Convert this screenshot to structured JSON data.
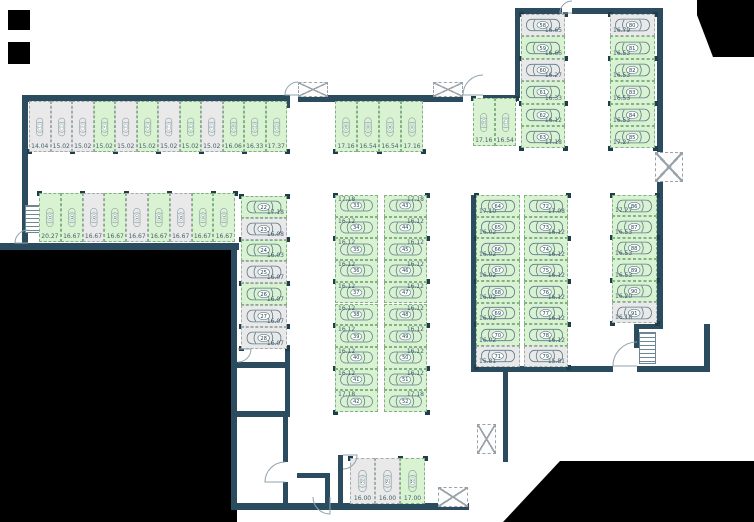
{
  "canvas": {
    "w": 754,
    "h": 522
  },
  "colors": {
    "available_fill": "#d9f2d2",
    "available_border": "#82b184",
    "occupied_fill": "#e9e9e9",
    "occupied_border": "#a6abad",
    "wall": "#2b4c5e",
    "outside": "#000000",
    "label_text": "#45606d",
    "car_outline": "#5d7a87",
    "badge_fill": "#ffffff",
    "badge_text": "#24454f",
    "column_dot": "#1f3e4b",
    "door_arc": "#8fa3ad"
  },
  "icons": {
    "car": "car-top-view-icon",
    "shaft": "crossed-shaft-icon",
    "stairs": "staircase-icon",
    "door": "door-swing-arc-icon"
  },
  "groups": [
    {
      "name": "top-row",
      "orient": "v",
      "x": 29,
      "y": 101,
      "sw": 21.5,
      "sh": 51,
      "dots": [
        "bottom"
      ],
      "label": "b",
      "spots": [
        {
          "n": "1",
          "a": "14.04",
          "s": "grey"
        },
        {
          "n": "2",
          "a": "15.02",
          "s": "grey"
        },
        {
          "n": "3",
          "a": "15.02",
          "s": "grey"
        },
        {
          "n": "4",
          "a": "15.02",
          "s": "green"
        },
        {
          "n": "5",
          "a": "15.02",
          "s": "grey"
        },
        {
          "n": "6",
          "a": "15.02",
          "s": "green"
        },
        {
          "n": "7",
          "a": "15.02",
          "s": "grey"
        },
        {
          "n": "8",
          "a": "15.02",
          "s": "green"
        },
        {
          "n": "9",
          "a": "15.02",
          "s": "grey"
        },
        {
          "n": "10",
          "a": "16.06",
          "s": "green"
        },
        {
          "n": "11",
          "a": "16.33",
          "s": "green"
        },
        {
          "n": "12",
          "a": "17.37",
          "s": "green"
        }
      ]
    },
    {
      "name": "second-row",
      "orient": "v",
      "x": 39,
      "y": 193,
      "sw": 21.8,
      "sh": 49,
      "dots": [
        "top"
      ],
      "label": "b",
      "spots": [
        {
          "n": "13",
          "a": "20.27",
          "s": "green"
        },
        {
          "n": "14",
          "a": "16.67",
          "s": "green"
        },
        {
          "n": "15",
          "a": "16.67",
          "s": "grey"
        },
        {
          "n": "16",
          "a": "16.67",
          "s": "green"
        },
        {
          "n": "17",
          "a": "16.67",
          "s": "grey"
        },
        {
          "n": "18",
          "a": "16.67",
          "s": "green"
        },
        {
          "n": "19",
          "a": "16.67",
          "s": "grey"
        },
        {
          "n": "20",
          "a": "16.67",
          "s": "green"
        },
        {
          "n": "21",
          "a": "16.67",
          "s": "green"
        }
      ]
    },
    {
      "name": "left-column",
      "orient": "h",
      "x": 241,
      "y": 196,
      "sw": 46,
      "sh": 21.8,
      "dots": [
        "left",
        "right"
      ],
      "label": "br",
      "spots": [
        {
          "n": "22",
          "a": "17.18",
          "s": "green"
        },
        {
          "n": "23",
          "a": "16.08",
          "s": "grey"
        },
        {
          "n": "24",
          "a": "16.03",
          "s": "green"
        },
        {
          "n": "25",
          "a": "16.07",
          "s": "grey"
        },
        {
          "n": "26",
          "a": "16.07",
          "s": "green"
        },
        {
          "n": "27",
          "a": "16.07",
          "s": "grey"
        },
        {
          "n": "28",
          "a": "16.07",
          "s": "grey"
        }
      ]
    },
    {
      "name": "top-middle-row",
      "orient": "v",
      "x": 335,
      "y": 101,
      "sw": 22,
      "sh": 51,
      "dots": [
        "bottom"
      ],
      "label": "b",
      "spots": [
        {
          "n": "29",
          "a": "17.16",
          "s": "green"
        },
        {
          "n": "30",
          "a": "16.54",
          "s": "green"
        },
        {
          "n": "31",
          "a": "16.54",
          "s": "green"
        },
        {
          "n": "32",
          "a": "17.16",
          "s": "green"
        }
      ]
    },
    {
      "name": "mid-column-left",
      "orient": "h",
      "x": 335,
      "y": 195,
      "sw": 43,
      "sh": 21.7,
      "dots": [
        "left"
      ],
      "label": "tl",
      "spots": [
        {
          "n": "33",
          "a": "17.18",
          "s": "green"
        },
        {
          "n": "34",
          "a": "16.12",
          "s": "green"
        },
        {
          "n": "35",
          "a": "16.12",
          "s": "green"
        },
        {
          "n": "36",
          "a": "16.12",
          "s": "green"
        },
        {
          "n": "37",
          "a": "16.12",
          "s": "green"
        },
        {
          "n": "38",
          "a": "16.12",
          "s": "green"
        },
        {
          "n": "39",
          "a": "16.12",
          "s": "green"
        },
        {
          "n": "40",
          "a": "16.12",
          "s": "green"
        },
        {
          "n": "41",
          "a": "16.12",
          "s": "green"
        },
        {
          "n": "42",
          "a": "17.18",
          "s": "green"
        }
      ]
    },
    {
      "name": "mid-column-right",
      "orient": "h",
      "x": 384,
      "y": 195,
      "sw": 43,
      "sh": 21.7,
      "dots": [
        "right"
      ],
      "label": "tr",
      "spots": [
        {
          "n": "43",
          "a": "17.18",
          "s": "green"
        },
        {
          "n": "44",
          "a": "16.12",
          "s": "green"
        },
        {
          "n": "45",
          "a": "16.12",
          "s": "green"
        },
        {
          "n": "46",
          "a": "16.12",
          "s": "green"
        },
        {
          "n": "47",
          "a": "16.12",
          "s": "green"
        },
        {
          "n": "48",
          "a": "16.12",
          "s": "green"
        },
        {
          "n": "49",
          "a": "16.12",
          "s": "green"
        },
        {
          "n": "50",
          "a": "16.12",
          "s": "green"
        },
        {
          "n": "51",
          "a": "16.12",
          "s": "green"
        },
        {
          "n": "52",
          "a": "17.18",
          "s": "green"
        }
      ]
    },
    {
      "name": "bottom-middle-row",
      "orient": "v",
      "x": 350,
      "y": 458,
      "sw": 25,
      "sh": 46,
      "dots": [
        "top"
      ],
      "label": "b",
      "spots": [
        {
          "n": "53",
          "a": "16.00",
          "s": "grey"
        },
        {
          "n": "54",
          "a": "16.00",
          "s": "grey"
        },
        {
          "n": "55",
          "a": "17.00",
          "s": "green"
        }
      ]
    },
    {
      "name": "upper-right-pair",
      "orient": "v",
      "x": 473,
      "y": 98,
      "sw": 21.5,
      "sh": 48,
      "dots": [
        "top"
      ],
      "label": "b",
      "spots": [
        {
          "n": "56",
          "a": "17.16",
          "s": "green"
        },
        {
          "n": "57",
          "a": "16.54",
          "s": "green"
        }
      ]
    },
    {
      "name": "upper-right-column-left",
      "orient": "h",
      "x": 521,
      "y": 14,
      "sw": 44,
      "sh": 22.4,
      "dots": [
        "left",
        "right"
      ],
      "label": "br",
      "spots": [
        {
          "n": "58",
          "a": "16.65",
          "s": "grey"
        },
        {
          "n": "59",
          "a": "16.66",
          "s": "green"
        },
        {
          "n": "60",
          "a": "16.27",
          "s": "grey"
        },
        {
          "n": "61",
          "a": "16.33",
          "s": "green"
        },
        {
          "n": "62",
          "a": "16.12",
          "s": "green"
        },
        {
          "n": "63",
          "a": "17.18",
          "s": "green"
        }
      ]
    },
    {
      "name": "upper-right-column-right",
      "orient": "h",
      "x": 610,
      "y": 14,
      "sw": 45,
      "sh": 22.4,
      "dots": [
        "left",
        "right"
      ],
      "label": "bl",
      "spots": [
        {
          "n": "80",
          "a": "16.79",
          "s": "grey"
        },
        {
          "n": "81",
          "a": "16.53",
          "s": "green"
        },
        {
          "n": "82",
          "a": "16.53",
          "s": "green"
        },
        {
          "n": "83",
          "a": "16.53",
          "s": "green"
        },
        {
          "n": "84",
          "a": "16.53",
          "s": "green"
        },
        {
          "n": "85",
          "a": "17.27",
          "s": "green"
        }
      ]
    },
    {
      "name": "right-column-inner",
      "orient": "h",
      "x": 476,
      "y": 195,
      "sw": 44,
      "sh": 21.5,
      "dots": [
        "left"
      ],
      "label": "bl",
      "spots": [
        {
          "n": "64",
          "a": "17.10",
          "s": "green"
        },
        {
          "n": "65",
          "a": "16.02",
          "s": "green"
        },
        {
          "n": "66",
          "a": "16.02",
          "s": "green"
        },
        {
          "n": "67",
          "a": "16.02",
          "s": "green"
        },
        {
          "n": "68",
          "a": "16.02",
          "s": "green"
        },
        {
          "n": "69",
          "a": "16.02",
          "s": "green"
        },
        {
          "n": "70",
          "a": "16.02",
          "s": "green"
        },
        {
          "n": "71",
          "a": "15.81",
          "s": "grey"
        }
      ]
    },
    {
      "name": "right-column-outer",
      "orient": "h",
      "x": 524,
      "y": 195,
      "sw": 44,
      "sh": 21.5,
      "dots": [
        "right"
      ],
      "label": "br",
      "spots": [
        {
          "n": "72",
          "a": "17.08",
          "s": "green"
        },
        {
          "n": "73",
          "a": "16.12",
          "s": "green"
        },
        {
          "n": "74",
          "a": "16.12",
          "s": "green"
        },
        {
          "n": "75",
          "a": "16.12",
          "s": "green"
        },
        {
          "n": "76",
          "a": "16.12",
          "s": "green"
        },
        {
          "n": "77",
          "a": "16.12",
          "s": "green"
        },
        {
          "n": "78",
          "a": "16.12",
          "s": "green"
        },
        {
          "n": "79",
          "a": "15.81",
          "s": "grey"
        }
      ]
    },
    {
      "name": "far-right-column",
      "orient": "h",
      "x": 612,
      "y": 195,
      "sw": 45,
      "sh": 21.4,
      "dots": [
        "left",
        "right"
      ],
      "label": "bl",
      "spots": [
        {
          "n": "86",
          "a": "17.27",
          "s": "green"
        },
        {
          "n": "87",
          "a": "16.53",
          "s": "green"
        },
        {
          "n": "88",
          "a": "16.53",
          "s": "green"
        },
        {
          "n": "89",
          "a": "16.53",
          "s": "green"
        },
        {
          "n": "90",
          "a": "16.20",
          "s": "green"
        },
        {
          "n": "91",
          "a": "16.18",
          "s": "grey"
        }
      ]
    }
  ],
  "structure": {
    "walls": [
      [
        22,
        95,
        268,
        7
      ],
      [
        22,
        95,
        6,
        150
      ],
      [
        0,
        243,
        239,
        7
      ],
      [
        284,
        95,
        6,
        13
      ],
      [
        298,
        95,
        165,
        7
      ],
      [
        483,
        95,
        34,
        7
      ],
      [
        515,
        12,
        5,
        86
      ],
      [
        515,
        8,
        47,
        6
      ],
      [
        572,
        8,
        91,
        6
      ],
      [
        657,
        8,
        6,
        146
      ],
      [
        657,
        182,
        6,
        146
      ],
      [
        634,
        324,
        29,
        5
      ],
      [
        704,
        324,
        6,
        48
      ],
      [
        634,
        324,
        5,
        24
      ],
      [
        471,
        195,
        5,
        177
      ],
      [
        471,
        366,
        142,
        6
      ],
      [
        637,
        366,
        73,
        6
      ],
      [
        503,
        372,
        5,
        90
      ],
      [
        231,
        248,
        6,
        262
      ],
      [
        237,
        362,
        53,
        6
      ],
      [
        285,
        345,
        5,
        72
      ],
      [
        237,
        411,
        52,
        6
      ],
      [
        283,
        417,
        5,
        45
      ],
      [
        283,
        482,
        5,
        26
      ],
      [
        231,
        503,
        238,
        7
      ],
      [
        297,
        473,
        33,
        5
      ],
      [
        325,
        478,
        5,
        27
      ],
      [
        338,
        455,
        5,
        50
      ]
    ],
    "outside_rects": [
      [
        0,
        250,
        237,
        272
      ],
      [
        8,
        10,
        22,
        20
      ],
      [
        8,
        42,
        22,
        22
      ]
    ],
    "outside_polys": [
      [
        [
          697,
          0
        ],
        [
          754,
          0
        ],
        [
          754,
          57
        ],
        [
          713,
          57
        ],
        [
          697,
          15
        ]
      ],
      [
        [
          560,
          461
        ],
        [
          754,
          461
        ],
        [
          754,
          522
        ],
        [
          503,
          522
        ]
      ]
    ],
    "shafts": [
      [
        298,
        82,
        30,
        15
      ],
      [
        433,
        82,
        30,
        15
      ],
      [
        655,
        152,
        28,
        30
      ],
      [
        477,
        424,
        19,
        30
      ],
      [
        438,
        487,
        30,
        20
      ]
    ],
    "stairs": [
      [
        25,
        205,
        15,
        28
      ],
      [
        639,
        332,
        17,
        32
      ]
    ],
    "doors": [
      {
        "h": [
          298,
          95
        ],
        "r": 13,
        "a0": 180,
        "a1": 270
      },
      {
        "h": [
          483,
          95
        ],
        "r": 20,
        "a0": 180,
        "a1": 270
      },
      {
        "h": [
          572,
          13
        ],
        "r": 12,
        "a0": 180,
        "a1": 270
      },
      {
        "h": [
          637,
          366
        ],
        "r": 24,
        "a0": 180,
        "a1": 270
      },
      {
        "h": [
          238,
          349
        ],
        "r": 13,
        "a0": 0,
        "a1": 90
      },
      {
        "h": [
          285,
          482
        ],
        "r": 20,
        "a0": 180,
        "a1": 270
      },
      {
        "h": [
          343,
          455
        ],
        "r": 14,
        "a0": 0,
        "a1": 90
      },
      {
        "h": [
          330,
          497
        ],
        "r": 17,
        "a0": 90,
        "a1": 180
      },
      {
        "h": [
          28,
          243
        ],
        "r": 13,
        "a0": 180,
        "a1": 270
      }
    ]
  }
}
